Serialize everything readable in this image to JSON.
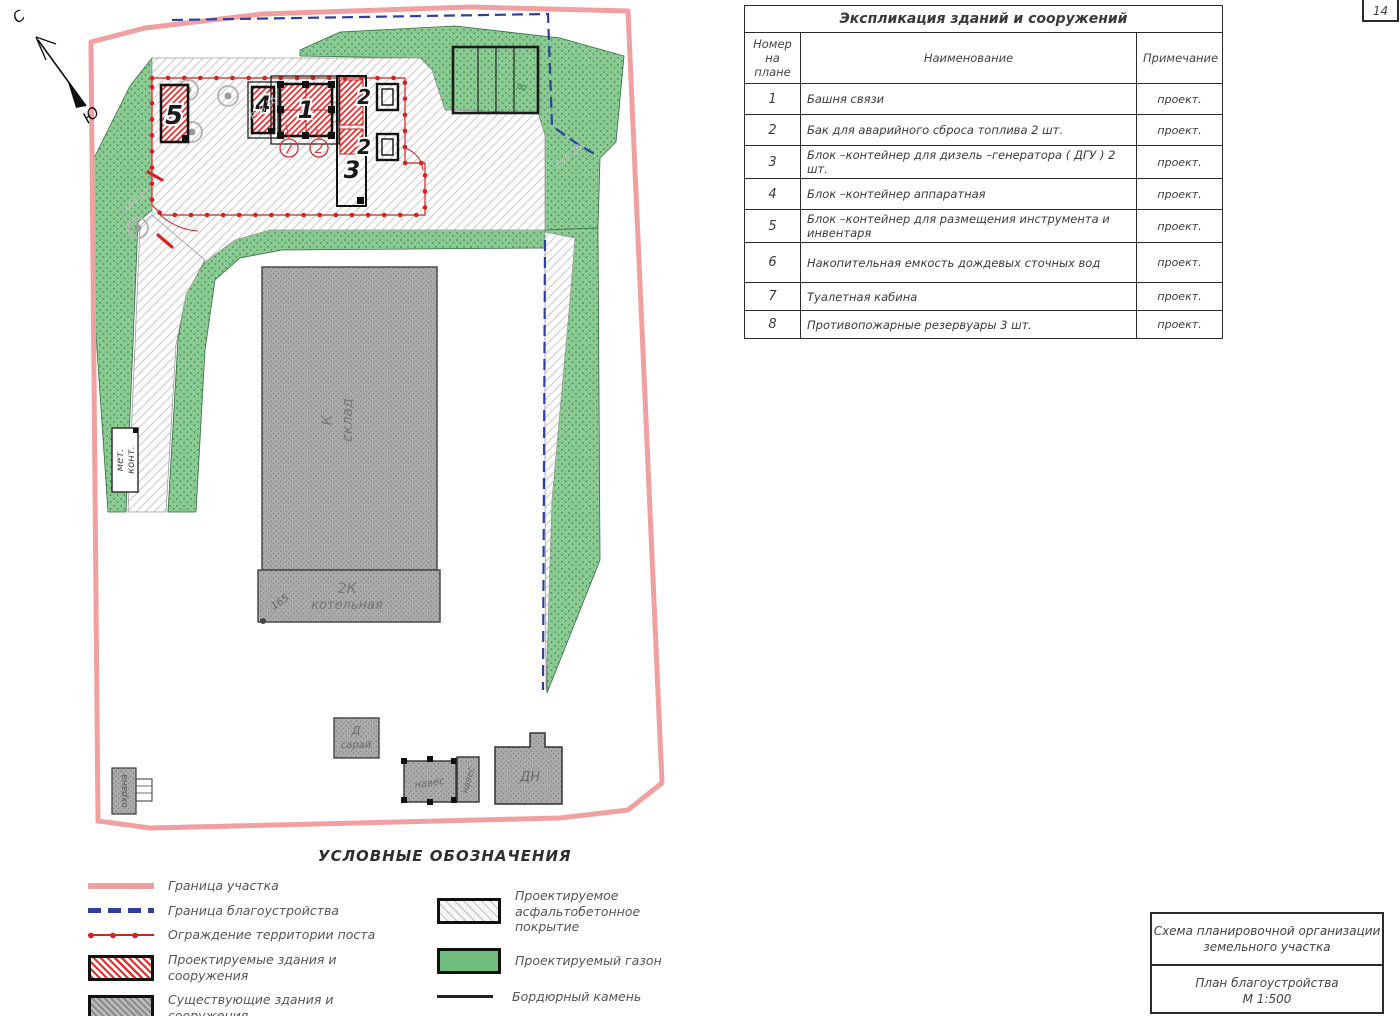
{
  "page": {
    "sheet": "14"
  },
  "colors": {
    "site_boundary_pink": "#f0a0a0",
    "improvement_boundary_blue": "#2f3fa0",
    "post_fence_red": "#d42222",
    "lawn_green": "#8bcb93",
    "projected_red": "#e03131",
    "existing_gray": "#ababab"
  },
  "explication": {
    "title": "Экспликация зданий и сооружений",
    "columns": {
      "num": "Номер на плане",
      "name": "Наименование",
      "note": "Примечание"
    },
    "rows": [
      {
        "n": "1",
        "name": "Башня связи",
        "note": "проект."
      },
      {
        "n": "2",
        "name": "Бак для аварийного сброса топлива  2 шт.",
        "note": "проект."
      },
      {
        "n": "3",
        "name": "Блок –контейнер для дизель –генератора ( ДГУ ) 2 шт.",
        "note": "проект."
      },
      {
        "n": "4",
        "name": "Блок –контейнер аппаратная",
        "note": "проект."
      },
      {
        "n": "5",
        "name": "Блок –контейнер для размещения инструмента и инвентаря",
        "note": "проект."
      },
      {
        "n": "6",
        "name": "Накопительная емкость дождевых сточных вод",
        "note": "проект."
      },
      {
        "n": "7",
        "name": "Туалетная кабина",
        "note": "проект."
      },
      {
        "n": "8",
        "name": "Противопожарные резервуары  3 шт.",
        "note": "проект."
      }
    ]
  },
  "legend": {
    "title": "УСЛОВНЫЕ ОБОЗНАЧЕНИЯ",
    "items_left": [
      {
        "label": "Граница участка"
      },
      {
        "label": "Граница благоустройства"
      },
      {
        "label": "Ограждение территории поста"
      },
      {
        "label": "Проектируемые здания и сооружения"
      },
      {
        "label": "Существующие здания и сооружения"
      }
    ],
    "items_right": [
      {
        "label": "Проектируемое асфальтобетонное покрытие"
      },
      {
        "label": "Проектируемый газон"
      },
      {
        "label": "Бордюрный камень"
      }
    ]
  },
  "stamp": {
    "row1_line1": "Схема планировочной организации",
    "row1_line2": "земельного участка",
    "row2_line1": "План благоустройства",
    "row2_line2": "М 1:500"
  },
  "plan": {
    "compass_n": "С",
    "compass_s": "Ю",
    "b5": "5",
    "b4": "4",
    "b1": "1",
    "b3": "3",
    "t2a": "2",
    "t2b": "2",
    "c7": "7",
    "c2": "2",
    "r8": "8",
    "sklad1": "К",
    "sklad2": "склад",
    "kot1": "2К",
    "kot2": "котельная",
    "n165": "165",
    "saray1": "Д",
    "saray2": "сарай",
    "naves1": "навес",
    "naves2": "навес",
    "dn": "ДН",
    "ohrana": "охрана",
    "met1": "мет.",
    "met2": "конт.",
    "u1": "ЕкВ 2б",
    "u2": "ЕкВ 2б",
    "u3": "хВ4 27"
  }
}
